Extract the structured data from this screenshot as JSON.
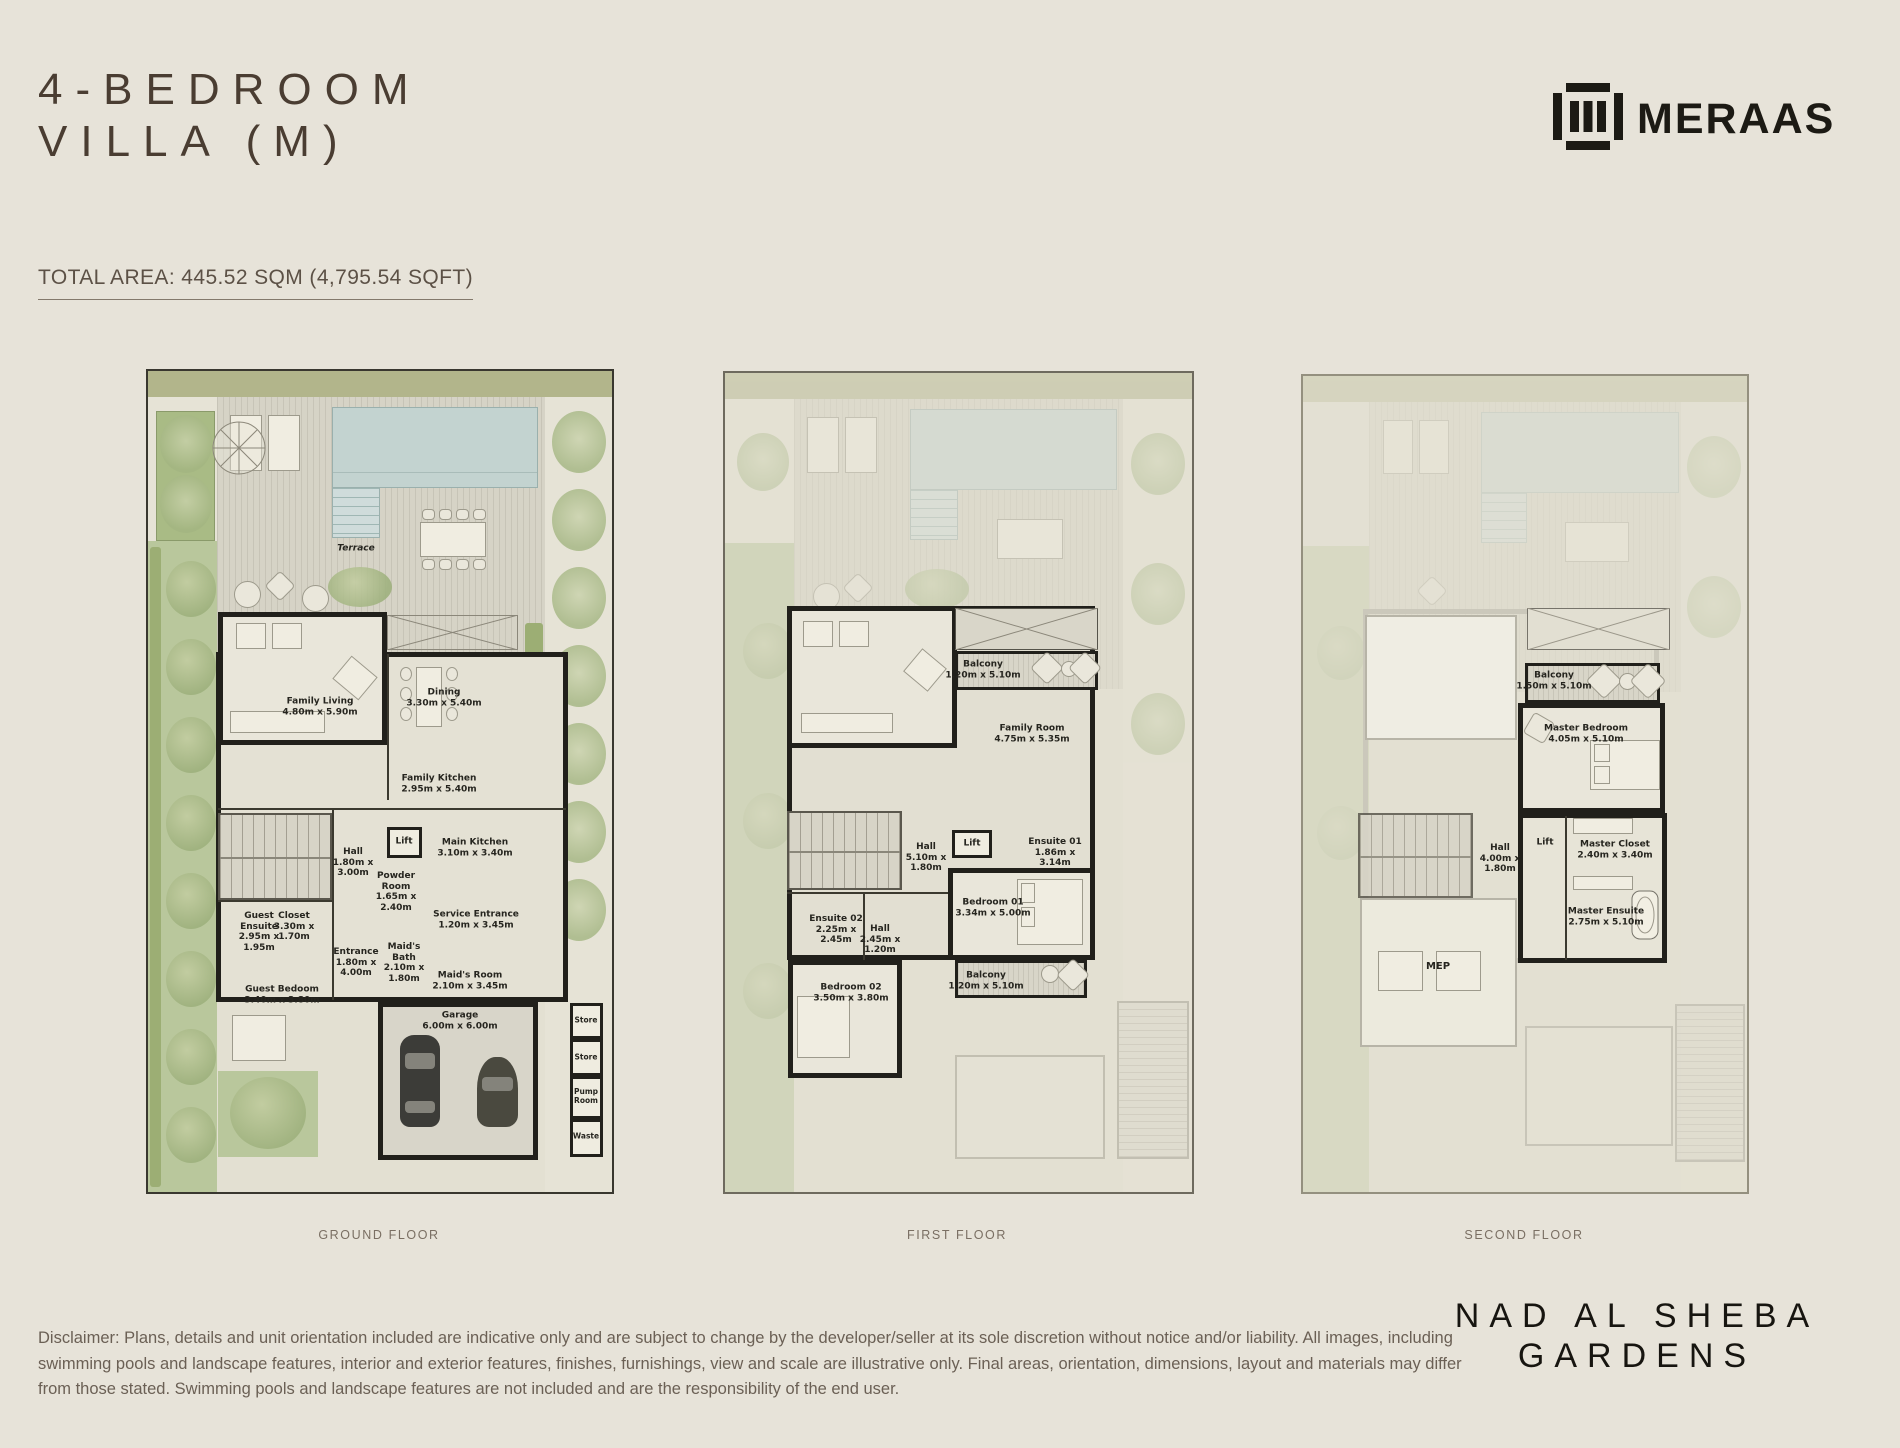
{
  "header": {
    "title_lines": [
      "4-BEDROOM",
      "VILLA (M)"
    ],
    "total_area": "TOTAL AREA: 445.52 SQM (4,795.54 SQFT)",
    "brand_name": "MERAAS"
  },
  "plans": [
    {
      "caption": "GROUND FLOOR",
      "rooms": {
        "terrace": {
          "name": "Terrace"
        },
        "family_living": {
          "name": "Family Living",
          "dims": "4.80m x 5.90m"
        },
        "dining": {
          "name": "Dining",
          "dims": "3.30m x 5.40m"
        },
        "family_kitchen": {
          "name": "Family Kitchen",
          "dims": "2.95m x 5.40m"
        },
        "lift": {
          "name": "Lift"
        },
        "hall": {
          "name": "Hall",
          "dims": "1.80m x 3.00m"
        },
        "main_kitchen": {
          "name": "Main Kitchen",
          "dims": "3.10m x 3.40m"
        },
        "powder_room": {
          "name": "Powder Room",
          "dims": "1.65m x 2.40m"
        },
        "service_entrance": {
          "name": "Service Entrance",
          "dims": "1.20m x 3.45m"
        },
        "guest_ensuite": {
          "name": "Guest Ensuite",
          "dims": "2.95m x 1.95m"
        },
        "closet": {
          "name": "Closet",
          "dims": "3.30m x 1.70m"
        },
        "entrance": {
          "name": "Entrance",
          "dims": "1.80m x 4.00m"
        },
        "maids_bath": {
          "name": "Maid's Bath",
          "dims": "2.10m x 1.80m"
        },
        "maids_room": {
          "name": "Maid's Room",
          "dims": "2.10m x 3.45m"
        },
        "guest_bedroom": {
          "name": "Guest Bedoom",
          "dims": "3.40m x 3.80m"
        },
        "garage": {
          "name": "Garage",
          "dims": "6.00m x 6.00m"
        },
        "store_1": {
          "name": "Store"
        },
        "store_2": {
          "name": "Store"
        },
        "pump_room": {
          "name": "Pump Room"
        },
        "waste": {
          "name": "Waste"
        }
      }
    },
    {
      "caption": "FIRST FLOOR",
      "rooms": {
        "balcony_top": {
          "name": "Balcony",
          "dims": "1.20m x 5.10m"
        },
        "family_room": {
          "name": "Family Room",
          "dims": "4.75m x 5.35m"
        },
        "hall": {
          "name": "Hall",
          "dims": "5.10m x 1.80m"
        },
        "lift": {
          "name": "Lift"
        },
        "ensuite_01": {
          "name": "Ensuite 01",
          "dims": "1.86m x 3.14m"
        },
        "bedroom_01": {
          "name": "Bedroom 01",
          "dims": "3.34m x 5.00m"
        },
        "ensuite_02": {
          "name": "Ensuite 02",
          "dims": "2.25m x 2.45m"
        },
        "hall_2": {
          "name": "Hall",
          "dims": "2.45m x 1.20m"
        },
        "bedroom_02": {
          "name": "Bedroom 02",
          "dims": "3.50m x 3.80m"
        },
        "balcony_bottom": {
          "name": "Balcony",
          "dims": "1.20m x 5.10m"
        }
      }
    },
    {
      "caption": "SECOND FLOOR",
      "rooms": {
        "balcony": {
          "name": "Balcony",
          "dims": "1.50m x 5.10m"
        },
        "master_bedroom": {
          "name": "Master Bedroom",
          "dims": "4.05m x 5.10m"
        },
        "hall": {
          "name": "Hall",
          "dims": "4.00m x 1.80m"
        },
        "lift": {
          "name": "Lift"
        },
        "master_closet": {
          "name": "Master Closet",
          "dims": "2.40m x 3.40m"
        },
        "master_ensuite": {
          "name": "Master Ensuite",
          "dims": "2.75m x 5.10m"
        },
        "mep": {
          "name": "MEP"
        }
      }
    }
  ],
  "footer": {
    "disclaimer": "Disclaimer: Plans, details and unit orientation included are indicative only and are subject to change by the developer/seller at its sole discretion without notice and/or liability. All images, including swimming pools and landscape features, interior and exterior features, finishes, furnishings, view and scale are illustrative only. Final areas, orientation, dimensions, layout and materials may differ from those stated. Swimming pools and landscape features are not included and are the responsibility of the end user.",
    "project_lines": [
      "NAD AL SHEBA",
      "GARDENS"
    ]
  },
  "colors": {
    "background": "#e7e3d9",
    "title_brown": "#4a3d32",
    "wall_black": "#21201b",
    "pool_blue": "#c3d3d0",
    "garden_green": "#b9c79c",
    "brand_black": "#1c1a14"
  }
}
